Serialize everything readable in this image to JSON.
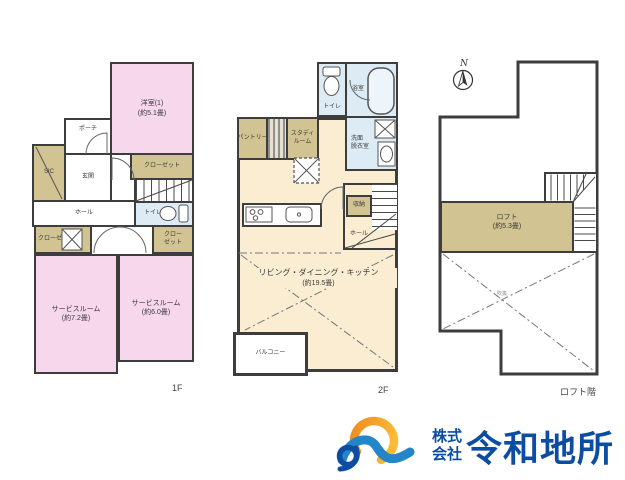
{
  "colors": {
    "room_pink": "#f7d7ec",
    "room_tan": "#d1c392",
    "room_blue": "#dcebf4",
    "room_cream": "#faedd2",
    "wall": "#3d3d3d",
    "logo_blue": "#0c4da2",
    "logo_light_blue": "#2386c8",
    "logo_orange": "#f6a623"
  },
  "compass": {
    "label": "N"
  },
  "floor1": {
    "floor_label": "1F",
    "yoshitsu_label": "洋室(1)",
    "yoshitsu_size": "(約5.1畳)",
    "porch": "ポーチ",
    "sic": "SIC",
    "genkan": "玄関",
    "hall": "ホール",
    "closet_top": "クローゼット",
    "toilet": "トイレ",
    "closet_left": "クローゼット",
    "closet_right_line1": "クロー",
    "closet_right_line2": "ゼット",
    "service1_label": "サービスルーム",
    "service1_size": "(約7.2畳)",
    "service2_label": "サービスルーム",
    "service2_size": "(約6.0畳)"
  },
  "floor2": {
    "floor_label": "2F",
    "toilet": "トイレ",
    "bath": "浴室",
    "senmen_line1": "洗面",
    "senmen_line2": "脱衣室",
    "pantry": "パントリー",
    "study_line1": "スタディ",
    "study_line2": "ルーム",
    "shuno": "収納",
    "hall": "ホール",
    "ldk_label": "リビング・ダイニング・キッチン",
    "ldk_size": "(約19.5畳)",
    "balcony": "バルコニー"
  },
  "loft": {
    "floor_label": "ロフト階",
    "loft_label": "ロフト",
    "loft_size": "(約5.3畳)",
    "void": "吹抜"
  },
  "logo": {
    "company_type_line1": "株式",
    "company_type_line2": "会社",
    "company_name": "令和地所"
  }
}
